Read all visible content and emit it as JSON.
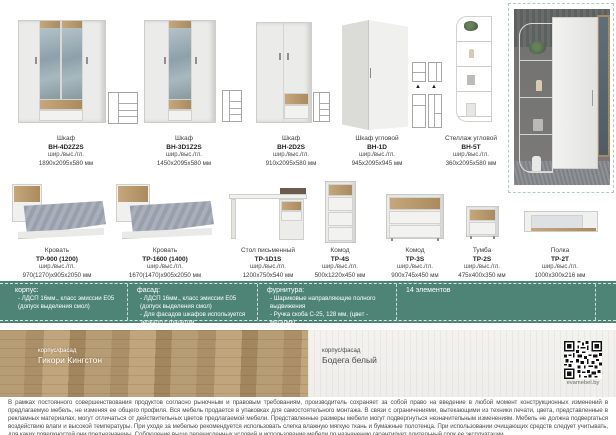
{
  "products_row1": [
    {
      "name": "Шкаф",
      "code": "ВН-4D2Z2S",
      "dims_label": "шир./выс./гл.",
      "size": "1890х2095х580 мм"
    },
    {
      "name": "Шкаф",
      "code": "ВН-3D1Z2S",
      "dims_label": "шир./выс./гл.",
      "size": "1450х2095х580 мм"
    },
    {
      "name": "Шкаф",
      "code": "ВН-2D2S",
      "dims_label": "шир./выс./гл.",
      "size": "910х2095х580 мм"
    },
    {
      "name": "Шкаф угловой",
      "code": "ВН-1D",
      "dims_label": "шир./выс./гл.",
      "size": "945х2095х945 мм"
    },
    {
      "name": "Стеллаж угловой",
      "code": "ВН-5Т",
      "dims_label": "шир./выс./гл.",
      "size": "360х2095х580 мм"
    }
  ],
  "products_row2": [
    {
      "name": "Кровать",
      "code": "ТР-900 (1200)",
      "dims_label": "шир./выс./гл.",
      "size": "970(1270)х905х2050 мм"
    },
    {
      "name": "Кровать",
      "code": "ТР-1600 (1400)",
      "dims_label": "шир./выс./гл.",
      "size": "1670(1470)х905х2050 мм"
    },
    {
      "name": "Стол письменный",
      "code": "ТР-1D1S",
      "dims_label": "шир./выс./гл.",
      "size": "1200х750х540 мм"
    },
    {
      "name": "Комод",
      "code": "ТР-4S",
      "dims_label": "шир./выс./гл.",
      "size": "500х1220х450 мм"
    },
    {
      "name": "Комод",
      "code": "ТР-3S",
      "dims_label": "шир./выс./гл.",
      "size": "900х745х450 мм"
    },
    {
      "name": "Тумба",
      "code": "ТР-2S",
      "dims_label": "шир./выс./гл.",
      "size": "475х400х350 мм"
    },
    {
      "name": "Полка",
      "code": "ТР-2Т",
      "dims_label": "шир./выс./гл.",
      "size": "1000х300х216 мм"
    }
  ],
  "info_bar": {
    "columns": [
      {
        "title": "корпус:",
        "items": [
          "- ЛДСП 16мм., класс эмиссии Е05 (допуск выделения смол)"
        ]
      },
      {
        "title": "фасад:",
        "items": [
          "- ЛДСП 16мм., класс эмиссии Е05 (допуск выделения смол)",
          "- Для фасадов шкафов используется зеркало с фацетом"
        ]
      },
      {
        "title": "фурнитура:",
        "items": [
          "- Шариковые направляющие полного выдвижения",
          "- Ручка скоба С-25, 128 мм, (цвет - металик)"
        ]
      },
      {
        "title": "14 элементов",
        "items": []
      }
    ]
  },
  "textures": {
    "left": {
      "caption": "корпус/фасад",
      "name": "Гикори Кингстон"
    },
    "right": {
      "caption": "корпус/фасад",
      "name": "Бодега белый"
    }
  },
  "qr_label": "evamebel.by",
  "footer": {
    "text": "В рамках постоянного совершенствования продуктов согласно рыночным и правовым требованиям, производитель сохраняет за собой право на введение в любой момент конструкционных изменений в предлагаемую мебель, не изменяя ее общего профиля. Вся мебель продается в упаковках для самостоятельного монтажа. В связи с ограничениями, вытекающими из техники печати, цвета, представленные в рекламных материалах, могут отличаться от действительных цветов предлагаемой мебели. Представленные размеры мебели могут подвергнуться незначительным изменениям. Мебель не должна подвергаться воздействию влаги и высокой температуры. При уходе за мебелью рекомендуется использовать слегка влажную мягкую ткань и бумажные полотенца. При использовании очищающих средств следует учитывать, для каких поверхностей они предназначены. Соблюдение выше перечисленных условий и использование мебели по назначению гарантирует длительный срок ее эксплуатации."
  },
  "colors": {
    "accent_green": "#4e8476",
    "dash_border": "#a9cfc3",
    "wood": "#b9996b"
  }
}
